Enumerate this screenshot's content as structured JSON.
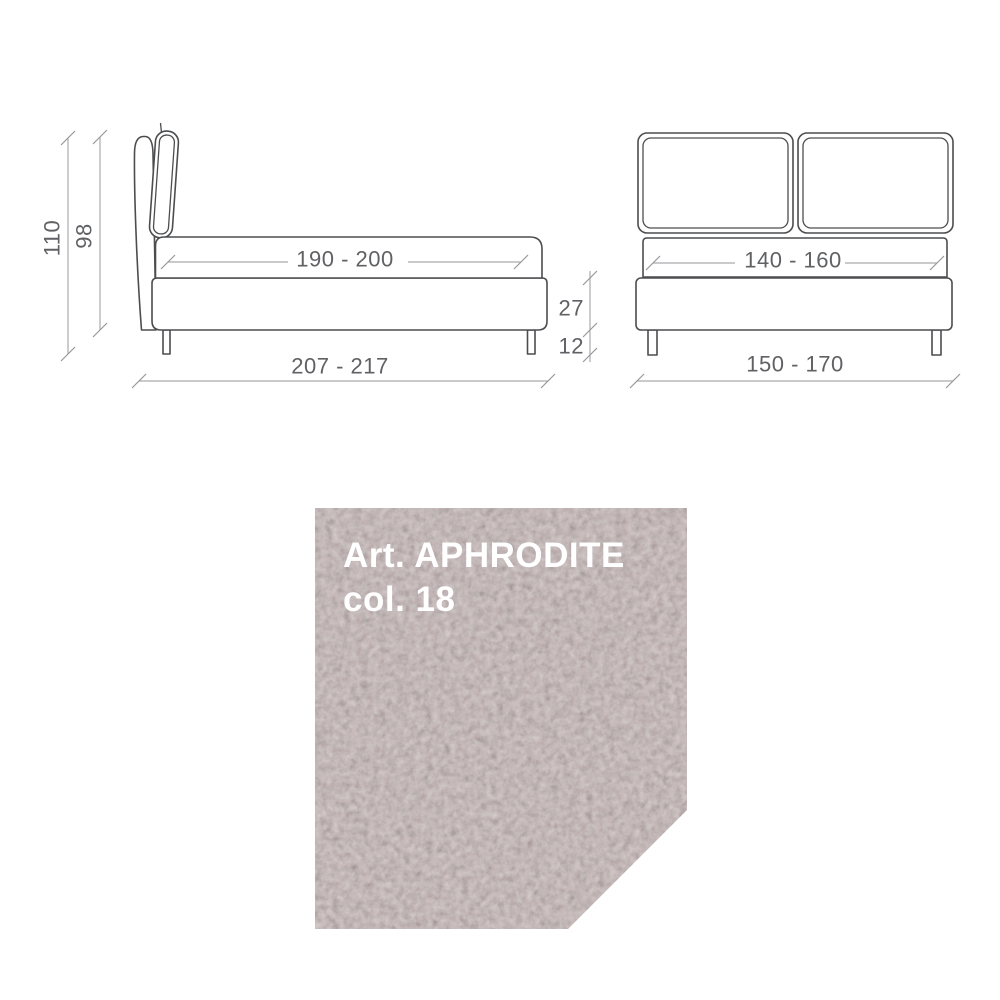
{
  "side_view": {
    "labels": {
      "total_height": "110",
      "headboard_height": "98",
      "sleep_length": "190 - 200",
      "frame_height": "27",
      "leg_height": "12",
      "total_length": "207 - 217"
    }
  },
  "front_view": {
    "labels": {
      "sleep_width": "140 - 160",
      "total_width": "150 - 170"
    }
  },
  "swatch": {
    "article_line": "Art. APHRODITE",
    "color_line": "col. 18",
    "label_color": "#ffffff",
    "fabric_base_color": "#b4a3a3",
    "fabric_dark_color": "#8b767a",
    "fabric_light_color": "#ddd3cf"
  },
  "style": {
    "outline_color": "#4c4d4f",
    "dim_line_color": "#a9abae",
    "dim_text_color": "#606164",
    "background": "#ffffff"
  }
}
